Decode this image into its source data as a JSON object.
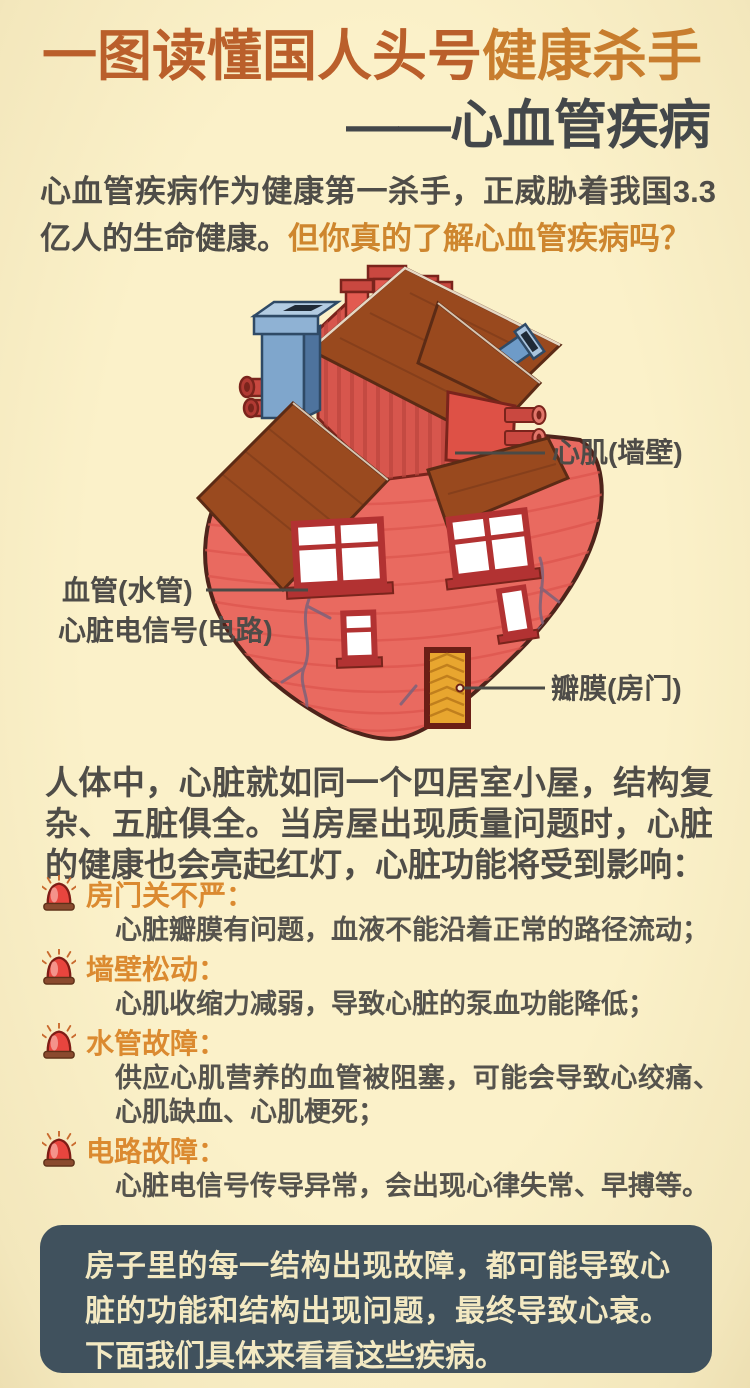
{
  "header": {
    "title_part1": "一图读懂国人头号",
    "title_part2": "健康杀手",
    "subtitle": "——心血管疾病"
  },
  "intro": {
    "text_normal": "心血管疾病作为健康第一杀手，正威胁着我国3.3亿人的生命健康。",
    "text_highlight": "但你真的了解心血管疾病吗？"
  },
  "diagram": {
    "labels": {
      "myocardium": "心肌(墙壁)",
      "blood_vessel": "血管(水管)",
      "electrical_signal": "心脏电信号(电路)",
      "valve": "瓣膜(房门)"
    }
  },
  "body_paragraph": "人体中，心脏就如同一个四居室小屋，结构复杂、五脏俱全。当房屋出现质量问题时，心脏的健康也会亮起红灯，心脏功能将受到影响：",
  "issues": [
    {
      "title": "房门关不严：",
      "desc": "心脏瓣膜有问题，血液不能沿着正常的路径流动；"
    },
    {
      "title": "墙壁松动：",
      "desc": "心肌收缩力减弱，导致心脏的泵血功能降低；"
    },
    {
      "title": "水管故障：",
      "desc": "供应心肌营养的血管被阻塞，可能会导致心绞痛、心肌缺血、心肌梗死；"
    },
    {
      "title": "电路故障：",
      "desc": "心脏电信号传导异常，会出现心律失常、早搏等。"
    }
  ],
  "footer": {
    "text": "房子里的每一结构出现故障，都可能导致心脏的功能和结构出现问题，最终导致心衰。下面我们具体来看看这些疾病。"
  },
  "colors": {
    "background": "#FAF0C6",
    "title_orange": "#BA5F2B",
    "title_orange_light": "#C87D2E",
    "title_dark": "#43474A",
    "text_gray": "#4F4D48",
    "accent_orange": "#CE862E",
    "list_title_orange": "#DB8A30",
    "footer_bg": "#40515D",
    "footer_text": "#F3E9C2",
    "heart_red": "#E96A60",
    "roof_brown": "#99491E",
    "chimney_blue": "#7FA6CC"
  }
}
